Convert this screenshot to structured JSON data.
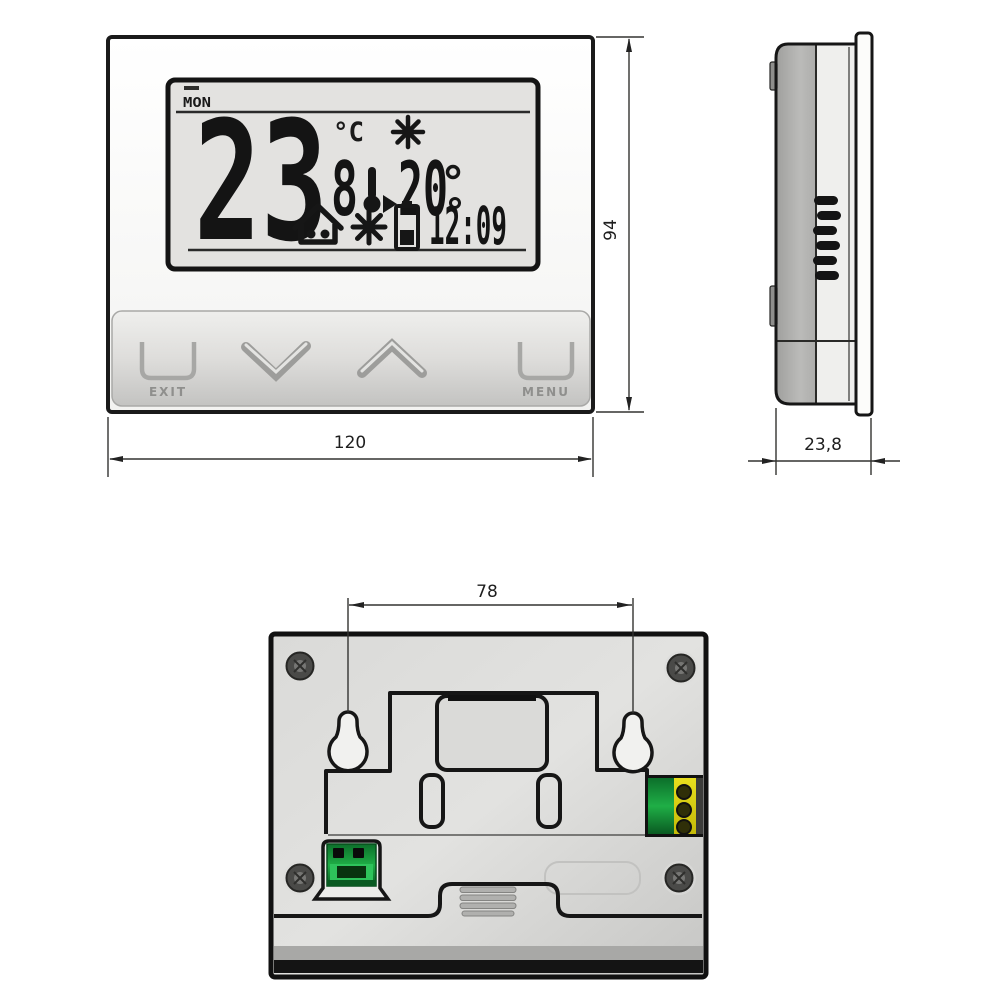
{
  "meta": {
    "type": "technical dimensional drawing",
    "subject": "digital room thermostat (front, side and back views)"
  },
  "views": {
    "front": {
      "lcd": {
        "day": "MON",
        "temperature": "23",
        "temperature_unit": "°C",
        "program_digit": "8",
        "setpoint_temperature": "20",
        "time": "12:09",
        "icons": [
          "sun-icon",
          "thermometer-arrow-icon",
          "house-icon",
          "sunburst-icon",
          "battery-icon"
        ]
      },
      "buttons": {
        "exit": "EXIT",
        "menu": "MENU",
        "down_icon": "chevron-down",
        "up_icon": "chevron-up"
      },
      "width_label": "120",
      "height_label": "94"
    },
    "side": {
      "depth_label": "23,8",
      "features": [
        "vent-slots",
        "mount-clips",
        "front-bezel-plate"
      ]
    },
    "back": {
      "hole_spacing_label": "78",
      "features": [
        "keyhole-mounts",
        "corner-screws",
        "green-terminal-block",
        "green-yellow-terminal-block",
        "vent-slots"
      ]
    }
  },
  "colors": {
    "line": "#1a1a1a",
    "lcd_background": "#e3e2e0",
    "panel_gray": "#cfcfcd",
    "terminal_green": "#1f9e42",
    "terminal_yellow": "#ddd116"
  }
}
